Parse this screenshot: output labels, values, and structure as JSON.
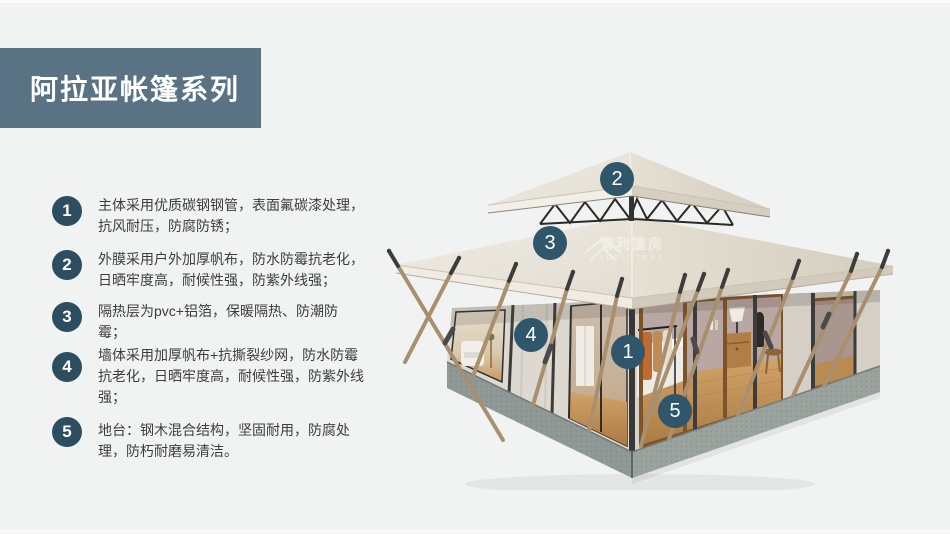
{
  "page": {
    "title": "阿拉亚帐篷系列",
    "background": "#f1f2f2",
    "colors": {
      "accent_banner": "#5a7384",
      "list_badge": "#2d4d60",
      "image_marker": "#2f566b",
      "body_text": "#3d3d3d"
    }
  },
  "features": [
    {
      "num": "1",
      "text": "主体采用优质碳钢钢管，表面氟碳漆处理，抗风耐压，防腐防锈；"
    },
    {
      "num": "2",
      "text": "外膜采用户外加厚帆布，防水防霉抗老化，日晒牢度高，耐候性强，防紫外线强；"
    },
    {
      "num": "3",
      "text": "隔热层为pvc+铝箔，保暖隔热、防潮防霉；"
    },
    {
      "num": "4",
      "text": "墙体采用加厚帆布+抗撕裂纱网，防水防霉抗老化，日晒牢度高，耐候性强，防紫外线强；"
    },
    {
      "num": "5",
      "text": "地台：钢木混合结构，坚固耐用，防腐处理，防朽耐磨易清洁。"
    }
  ],
  "markers": [
    "1",
    "2",
    "3",
    "4",
    "5"
  ],
  "watermark": {
    "cn": "雪利篷房",
    "en": "XUELI TENT"
  }
}
